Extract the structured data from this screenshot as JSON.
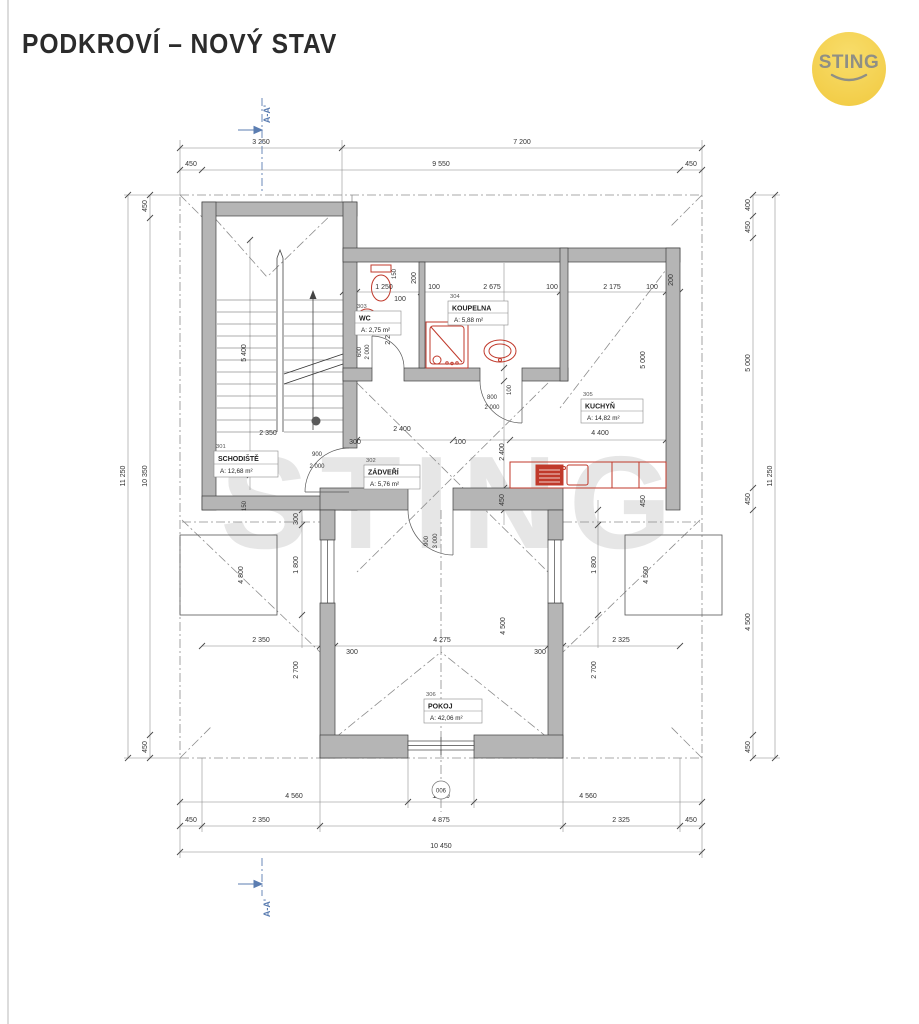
{
  "page": {
    "title": "PODKROVÍ – NOVÝ STAV"
  },
  "logo": {
    "text": "STING"
  },
  "watermark": "STING",
  "section": {
    "top_label": "A-A'",
    "bottom_label": "A-A'"
  },
  "marker": {
    "window": "006"
  },
  "rooms": [
    {
      "num": "301",
      "name": "SCHODIŠTĚ",
      "area": "A: 12,68 m²"
    },
    {
      "num": "302",
      "name": "ZÁDVEŘÍ",
      "area": "A: 5,76 m²"
    },
    {
      "num": "303",
      "name": "WC",
      "area": "A: 2,75 m²"
    },
    {
      "num": "304",
      "name": "KOUPELNA",
      "area": "A: 5,88 m²"
    },
    {
      "num": "305",
      "name": "KUCHYŇ",
      "area": "A: 14,82 m²"
    },
    {
      "num": "306",
      "name": "POKOJ",
      "area": "A: 42,06 m²"
    }
  ],
  "dims": {
    "top": [
      "3 250",
      "7 200",
      "450",
      "9 550",
      "450"
    ],
    "left": [
      "450",
      "10 350",
      "450",
      "11 250"
    ],
    "right": [
      "400",
      "450",
      "5 000",
      "450",
      "4 500",
      "450",
      "11 250"
    ],
    "bottom": [
      "4 560",
      "1 330",
      "4 560",
      "450",
      "2 350",
      "4 875",
      "2 325",
      "450",
      "10 450"
    ],
    "wc": [
      "1 250",
      "100",
      "2 200",
      "200",
      "150"
    ],
    "koupelna": [
      "100",
      "2 675",
      "100",
      "2 500",
      "100"
    ],
    "kuchyn": [
      "2 175",
      "100",
      "200",
      "5 000",
      "4 400",
      "2 400",
      "450",
      "450"
    ],
    "zadveri": [
      "2 400",
      "300",
      "100"
    ],
    "stairs": [
      "5 400",
      "2 350"
    ],
    "pokoj": [
      "4 275",
      "300",
      "300",
      "4 500"
    ],
    "left_mid": [
      "150",
      "300",
      "1 800",
      "2 350",
      "2 700",
      "4 800"
    ],
    "right_mid": [
      "1 800",
      "2 325",
      "2 700",
      "4 500"
    ],
    "doors": {
      "wc": [
        "600",
        "2 000"
      ],
      "koupelna": [
        "800",
        "2 000"
      ],
      "stairs": [
        "900",
        "2 000"
      ],
      "main": [
        "900",
        "3 000"
      ]
    }
  },
  "colors": {
    "wall": "#b5b5b5",
    "fixture": "#c0392b",
    "logo_bg": "#f5d050",
    "section": "#5b7db1"
  }
}
